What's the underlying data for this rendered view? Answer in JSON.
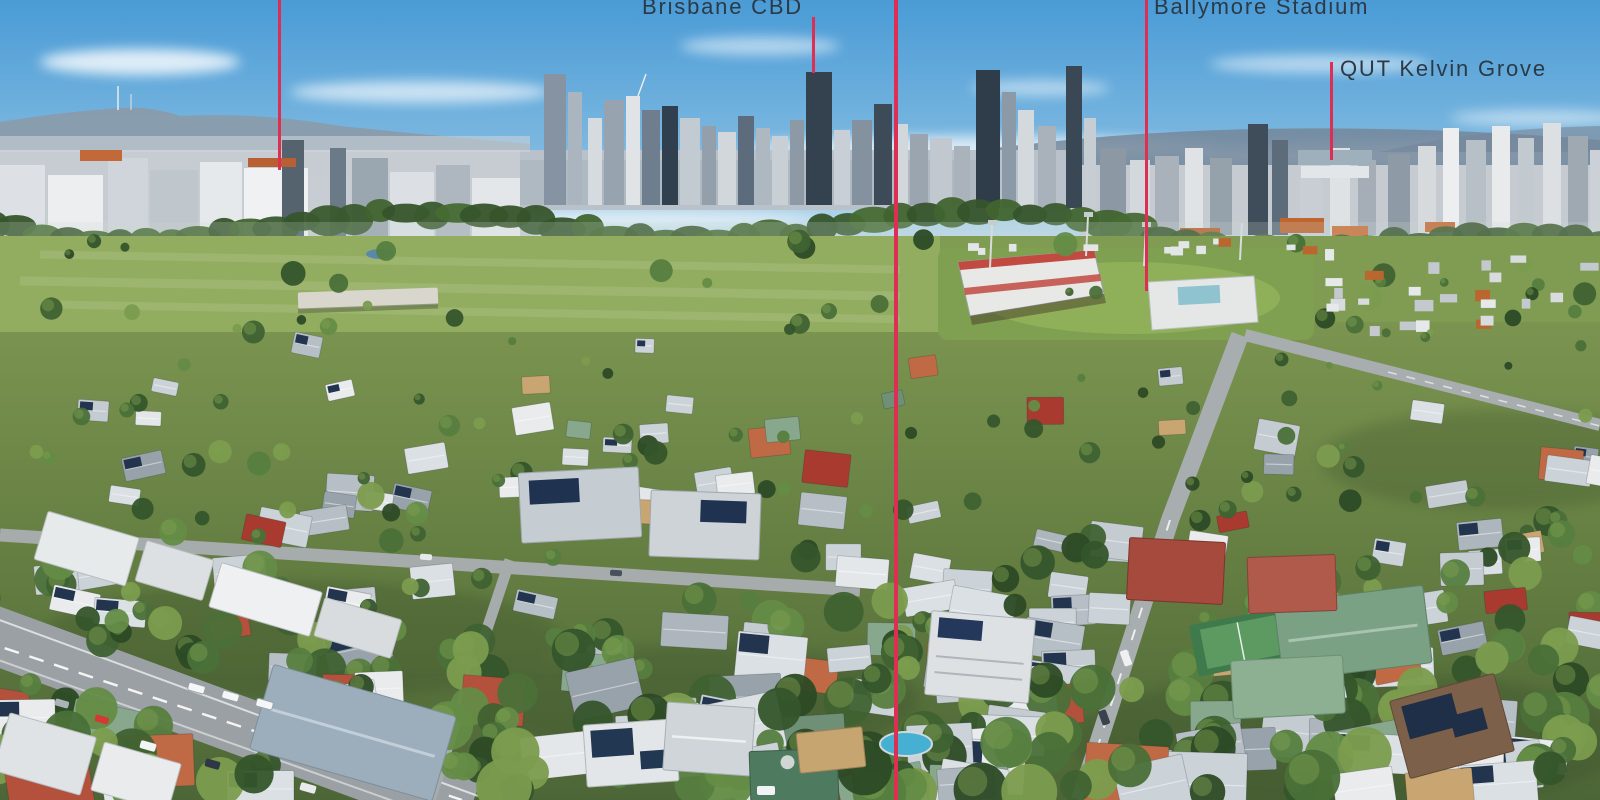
{
  "annotations": {
    "marker_color": "#dc2f53",
    "label_color": "#2b3a46",
    "markers": [
      {
        "id": "left-landmark",
        "label": "",
        "x": 279,
        "y1": 0,
        "y2": 170,
        "w": 3
      },
      {
        "id": "brisbane-cbd",
        "label": "Brisbane CBD",
        "x": 813,
        "y1": 17,
        "y2": 73,
        "w": 3,
        "label_x": 642,
        "label_y": -5
      },
      {
        "id": "center-property",
        "label": "",
        "x": 896,
        "y1": 0,
        "y2": 800,
        "w": 4
      },
      {
        "id": "ballymore-stadium",
        "label": "Ballymore Stadium",
        "x": 1146,
        "y1": 0,
        "y2": 291,
        "w": 3,
        "label_x": 1154,
        "label_y": -5
      },
      {
        "id": "qut-kelvin-grove",
        "label": "QUT Kelvin Grove",
        "x": 1331,
        "y1": 62,
        "y2": 160,
        "w": 3,
        "label_x": 1340,
        "label_y": 57
      }
    ]
  }
}
